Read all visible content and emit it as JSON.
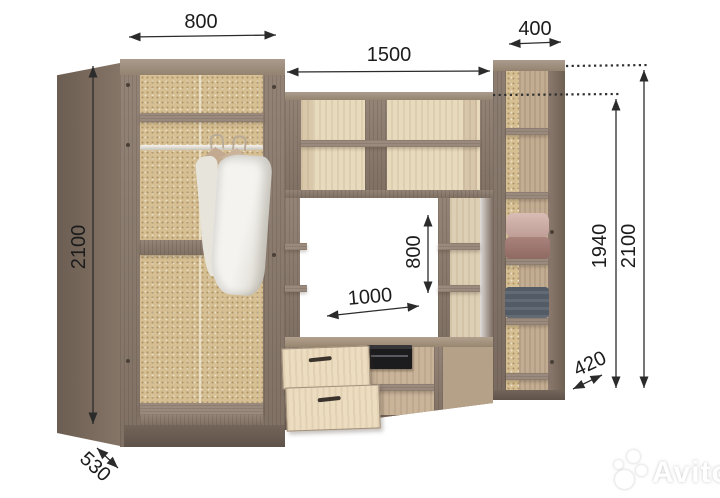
{
  "diagram": {
    "type": "furniture-dimension-drawing",
    "subject": "wall unit with wardrobe, TV niche and shelving"
  },
  "dims": {
    "wardrobe_width": "800",
    "center_width": "1500",
    "right_width": "400",
    "left_height": "2100",
    "niche_height": "800",
    "niche_width": "1000",
    "right_inner_height": "1940",
    "right_height": "2100",
    "right_depth": "420",
    "wardrobe_depth": "530"
  },
  "watermark": {
    "brand": "Avito"
  },
  "colors": {
    "background": "#ffffff",
    "frame_wood": "#8b7a6d",
    "light_wood": "#e8dabd",
    "back_panel_speckle": "#d5bf93",
    "plinth": "#6e5f54",
    "dimension_line": "#2b2b2b",
    "drawer_front": "#ecdcc0",
    "device_black": "#1c1c1e"
  }
}
